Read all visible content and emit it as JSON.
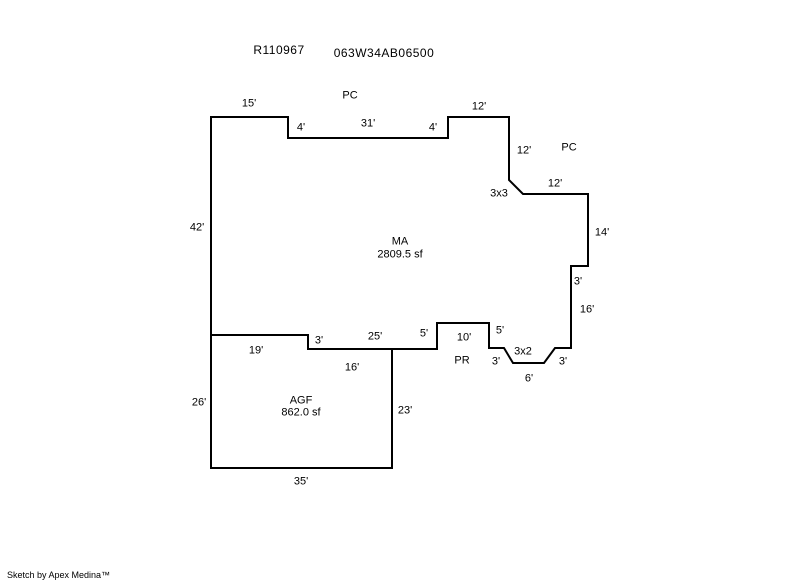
{
  "page": {
    "background_color": "#ffffff",
    "line_color": "#000000"
  },
  "header": {
    "report_number": "R110967",
    "taxlot_id": "063W34AB06500"
  },
  "diagram": {
    "stroke_color": "#000000",
    "stroke_width": 2,
    "areas": [
      {
        "code": "MA",
        "area_sf": "2809.5 sf"
      },
      {
        "code": "AGF",
        "area_sf": "862.0 sf"
      }
    ],
    "polygons": [
      {
        "name": "main-area-outline",
        "points": "211,117 288,117 288,138 448,138 448,117 509,117 509,180 523,194 588,194 588,266 571,266 571,348 555,348 544,363 513,363 504,348 489,348 489,323 437,323 437,349 308,349 308,335 211,335"
      },
      {
        "name": "garage-outline",
        "points": "211,335 308,335 308,349 392,349 392,468 211,468"
      }
    ],
    "labels": [
      {
        "name": "label-pc-top",
        "text": "PC",
        "x": 350,
        "y": 96
      },
      {
        "name": "dim-15-top",
        "text": "15'",
        "x": 249,
        "y": 104
      },
      {
        "name": "dim-4-step-left",
        "text": "4'",
        "x": 301,
        "y": 128
      },
      {
        "name": "dim-31-top",
        "text": "31'",
        "x": 368,
        "y": 124
      },
      {
        "name": "dim-4-step-right",
        "text": "4'",
        "x": 433,
        "y": 128
      },
      {
        "name": "dim-12-top",
        "text": "12'",
        "x": 479,
        "y": 107
      },
      {
        "name": "dim-12-right-upper",
        "text": "12'",
        "x": 524,
        "y": 151
      },
      {
        "name": "label-pc-right",
        "text": "PC",
        "x": 569,
        "y": 148
      },
      {
        "name": "dim-3x3-corner",
        "text": "3x3",
        "x": 499,
        "y": 194
      },
      {
        "name": "dim-12-right-lower",
        "text": "12'",
        "x": 555,
        "y": 184
      },
      {
        "name": "dim-14-right",
        "text": "14'",
        "x": 602,
        "y": 233
      },
      {
        "name": "dim-42-left",
        "text": "42'",
        "x": 197,
        "y": 228
      },
      {
        "name": "area-code-ma",
        "text": "MA",
        "x": 400,
        "y": 242
      },
      {
        "name": "area-size-ma",
        "text": "2809.5 sf",
        "x": 400,
        "y": 255
      },
      {
        "name": "dim-3-right-step",
        "text": "3'",
        "x": 578,
        "y": 282
      },
      {
        "name": "dim-16-right",
        "text": "16'",
        "x": 587,
        "y": 310
      },
      {
        "name": "dim-3-notch-right",
        "text": "3'",
        "x": 563,
        "y": 362
      },
      {
        "name": "dim-6-notch-bottom",
        "text": "6'",
        "x": 529,
        "y": 379
      },
      {
        "name": "dim-3x2-corner",
        "text": "3x2",
        "x": 523,
        "y": 352
      },
      {
        "name": "dim-3-notch-left",
        "text": "3'",
        "x": 496,
        "y": 362
      },
      {
        "name": "dim-5-porch-right",
        "text": "5'",
        "x": 500,
        "y": 331
      },
      {
        "name": "dim-10-porch-top",
        "text": "10'",
        "x": 464,
        "y": 338
      },
      {
        "name": "label-pr",
        "text": "PR",
        "x": 462,
        "y": 361
      },
      {
        "name": "dim-5-porch-left",
        "text": "5'",
        "x": 424,
        "y": 334
      },
      {
        "name": "dim-3-garage-step",
        "text": "3'",
        "x": 319,
        "y": 341
      },
      {
        "name": "dim-25-ma-bottom",
        "text": "25'",
        "x": 375,
        "y": 337
      },
      {
        "name": "dim-16-garage-top",
        "text": "16'",
        "x": 352,
        "y": 368
      },
      {
        "name": "dim-19-garage-top",
        "text": "19'",
        "x": 256,
        "y": 351
      },
      {
        "name": "dim-26-garage-left",
        "text": "26'",
        "x": 199,
        "y": 403
      },
      {
        "name": "area-code-agf",
        "text": "AGF",
        "x": 301,
        "y": 401
      },
      {
        "name": "area-size-agf",
        "text": "862.0 sf",
        "x": 301,
        "y": 413
      },
      {
        "name": "dim-23-garage-right",
        "text": "23'",
        "x": 405,
        "y": 411
      },
      {
        "name": "dim-35-garage-bottom",
        "text": "35'",
        "x": 301,
        "y": 482
      }
    ]
  },
  "footer": {
    "credit": "Sketch by Apex Medina™"
  }
}
